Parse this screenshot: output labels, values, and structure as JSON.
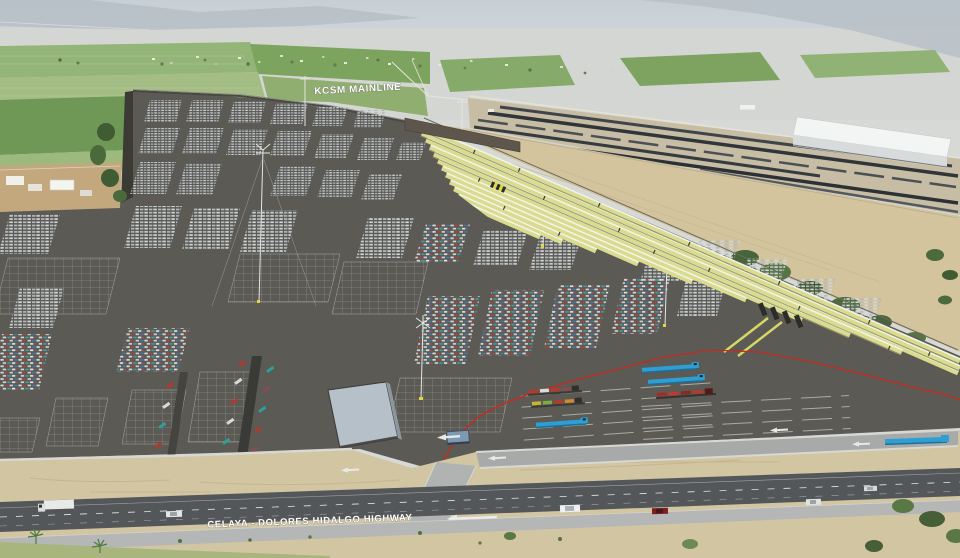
{
  "labels": {
    "rail_line": "KCSM MAINLINE",
    "highway": "CELAYA - DOLORES HIDALGO HIGHWAY"
  },
  "colors": {
    "asphalt": "#5b5a55",
    "ramp_yellow": "#d9db8e",
    "boundary_line_red": "#c8291d",
    "highway_asphalt": "#53575a",
    "warehouse_white": "#f3f5f4",
    "field_green": "#8eb173",
    "dry_field_tan": "#d3c49e",
    "carrier_truck_blue": "#2e9fd4",
    "perimeter_wall_gray": "#d8d8d2",
    "parking_line_white": "#aaaaa4"
  }
}
